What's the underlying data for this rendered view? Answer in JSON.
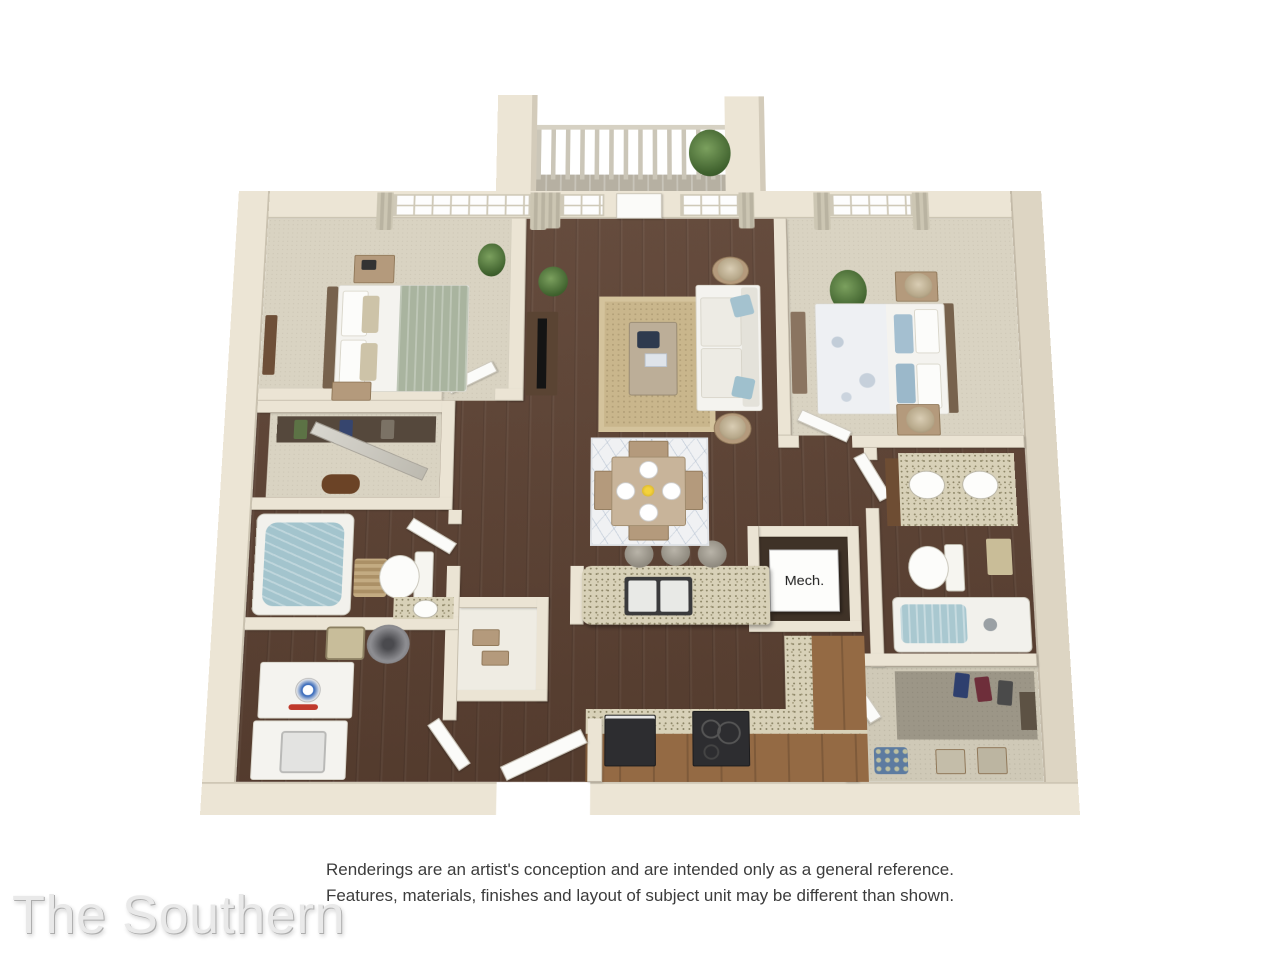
{
  "title": "The Southern",
  "disclaimer": {
    "line1": "Renderings are an artist's conception and are intended only as a general reference.",
    "line2": "Features, materials, finishes and layout of subject unit may be different than shown."
  },
  "labels": {
    "mech": "Mech."
  },
  "plan_rooms": [
    "bedroom-1",
    "closet-1",
    "bathroom-1",
    "laundry",
    "living-room",
    "dining-area",
    "kitchen",
    "mech-closet",
    "bedroom-2",
    "bathroom-2",
    "walk-in-closet-2",
    "balcony",
    "entry"
  ],
  "colors": {
    "background": "#ffffff",
    "wall": "#ebe4d4",
    "wood_floor": "#5d4233",
    "carpet": "#d9d3c2",
    "granite_counter": "#d8d1b8",
    "cabinet": "#946a44",
    "jute_rug": "#c9b68c",
    "bath_water": "#a3c4cd",
    "sage_blanket": "#a9b49f",
    "blue_pillow": "#a4bfd0",
    "title_text": "#e9e9e9",
    "disclaimer_text": "#3c3c3c"
  }
}
